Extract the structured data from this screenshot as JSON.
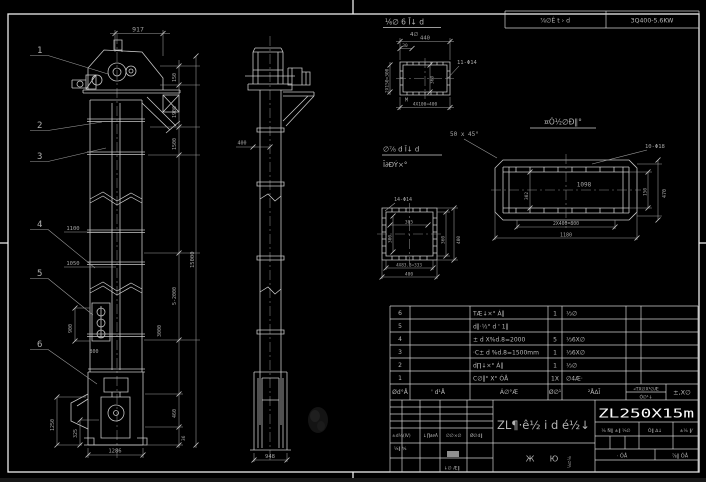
{
  "colors": {
    "background": "#000000",
    "line": "#c6c6c6",
    "frame": "#ededed",
    "dim_text": "#a5a5a5",
    "bright_text": "#fdfdfd"
  },
  "header": {
    "detail_title": "⅙∅ 6 Ī↓ d",
    "detail_scale": "4∅",
    "spec_left": "⅞∅Ê t › d",
    "spec_right": "3Q400-5.6KW"
  },
  "balloons": {
    "b1": "1",
    "b2": "2",
    "b3": "3",
    "b4": "4",
    "b5": "5",
    "b6": "6"
  },
  "front_dims": {
    "head_width": "917",
    "d150": "150",
    "d1900": "1900",
    "d1500": "1500",
    "mid": "5-2000",
    "low": "3000",
    "overall": "15000",
    "p1100": "1100",
    "p1050": "1050",
    "d900": "900",
    "d800": "800",
    "boot_h": "1250",
    "boot_i": "325",
    "boot_w": "1286",
    "r460": "460",
    "r36": "36"
  },
  "side_dims": {
    "w400": "400",
    "base": "948"
  },
  "detail_a": {
    "holes": "11-Φ14",
    "top": "440",
    "d30": "30",
    "left": "2X150=300",
    "inner": "360",
    "bottom": "4X100=400",
    "m": "M"
  },
  "chamfer_note": "50 x 45°",
  "spout": {
    "title": "¤Ó½∅Ð‖°",
    "holes": "10-Φ18",
    "inner": "1098",
    "inner_v": "302",
    "right_in": "150",
    "right_out": "470",
    "bottom_in": "2X400=800",
    "bottom_out": "1180"
  },
  "boot_flange": {
    "title1": "∅⅞ d Ī↓ d",
    "title2": "Ī∂ÐÝ×°",
    "holes": "14-Φ14",
    "top_in": "305",
    "left_in": "300",
    "right_in": "360",
    "right_out": "400",
    "bottom_in": "4X83.3=333",
    "bottom_out": "400"
  },
  "parts_table": {
    "rows": [
      {
        "no": "6",
        "name": "TÆ↓×° Á‖",
        "qty": "1",
        "material": "⅓∅"
      },
      {
        "no": "5",
        "name": "d‖·½° d ' 1‖",
        "qty": "",
        "material": ""
      },
      {
        "no": "4",
        "name": "± d X%d.8=2000",
        "qty": "5",
        "material": "⅓6X∅"
      },
      {
        "no": "3",
        "name": "·C± d %d.8=1500mm",
        "qty": "1",
        "material": "⅓6X∅"
      },
      {
        "no": "2",
        "name": "d∏↓×° Á‖",
        "qty": "1",
        "material": "⅓∅"
      },
      {
        "no": "1",
        "name": "C∅‖° X° ÓÅ",
        "qty": "1X",
        "material": "∅4Æ·"
      }
    ],
    "footer": {
      "code": "Ød°Å",
      "name2": "' d¹Å",
      "name": "Á∅°Æ",
      "qty": "Ø∅¹",
      "material": "²Å∆Ī",
      "note_top": "«TX∅X¹∅Æ",
      "note_bottom": "Ó∅¹↓",
      "weight": "±,X∅"
    }
  },
  "title_block": {
    "drawing_title": "ZL¶·ê½ i d é½↓",
    "sub1": "Ж",
    "sub2": "Ю",
    "stamp": "⅛∅⅛",
    "model": "ZL250X15m",
    "right_h1": "⅙ Ñ‖ ±‖ ⅓∅",
    "right_h2": "Ó‖ ∆↓",
    "right_h3": "±⅙ ‖⁄",
    "sheet1": "· ÓÅ",
    "sheet2": "⅞‖ ÓÅ",
    "left_r1c1": "±d⅛(Ⅳ)",
    "left_r1c2": "↓∏∂∂Ã",
    "left_r1c3": "∅∅×∅",
    "left_r1c4": "Ø∅d‖",
    "left_r2": "⅛‖ ⅍",
    "left_r3": "↓∅ Æ‖"
  }
}
